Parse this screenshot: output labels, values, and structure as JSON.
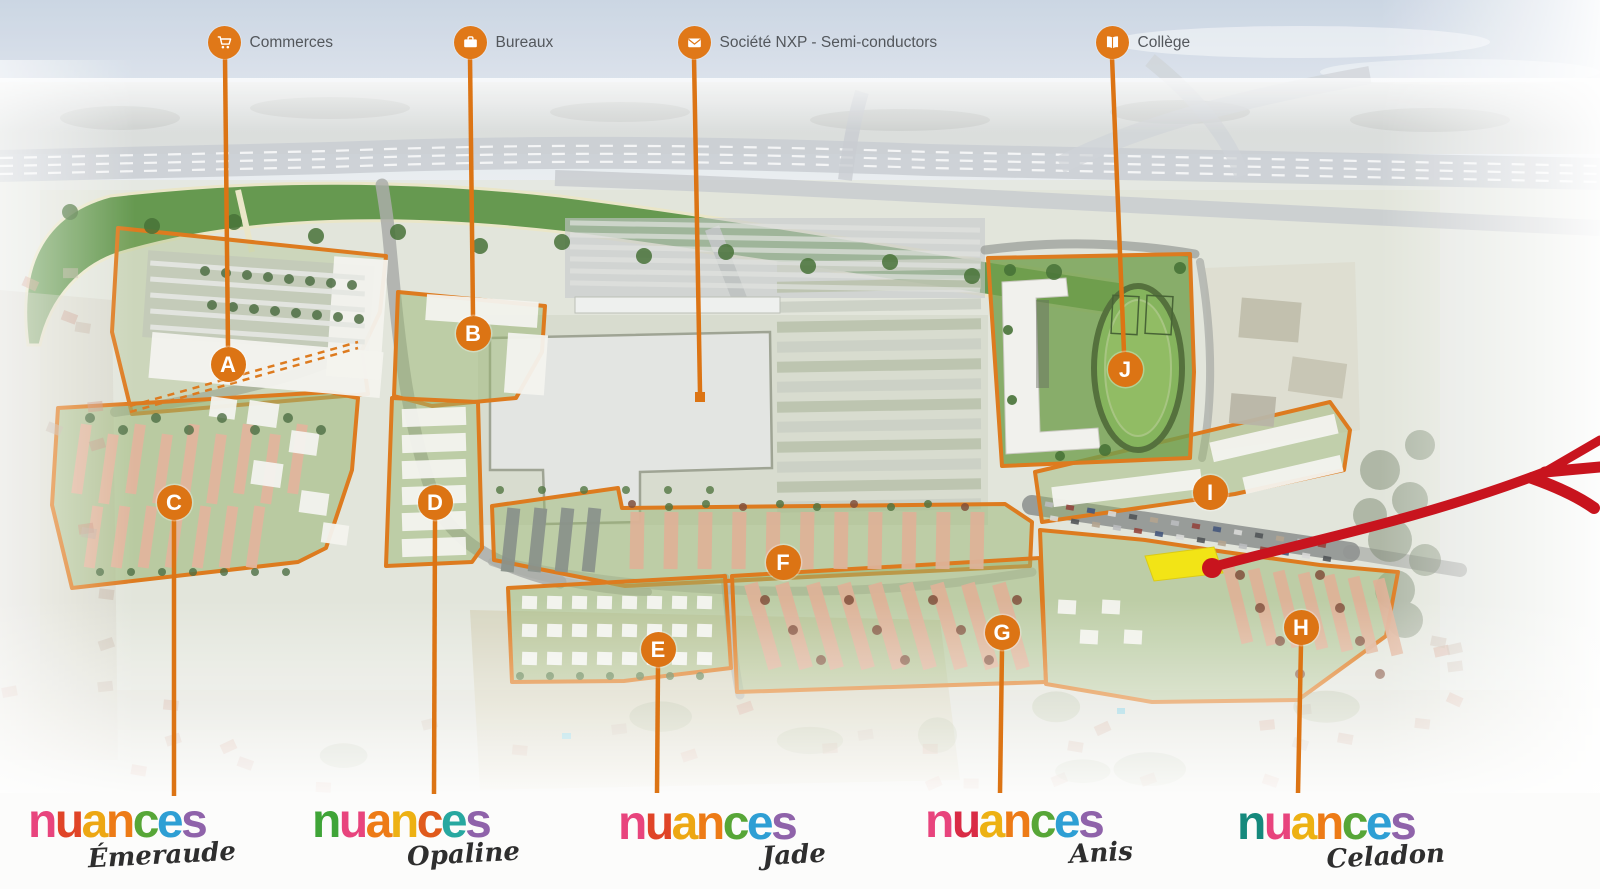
{
  "legend": {
    "items": [
      {
        "icon": "shopping-cart-icon",
        "label": "Commerces"
      },
      {
        "icon": "briefcase-icon",
        "label": "Bureaux"
      },
      {
        "icon": "envelope-icon",
        "label": "Société NXP - Semi-conductors"
      },
      {
        "icon": "open-book-icon",
        "label": "Collège"
      }
    ]
  },
  "zones": {
    "items": [
      {
        "letter": "A"
      },
      {
        "letter": "B"
      },
      {
        "letter": "C"
      },
      {
        "letter": "D"
      },
      {
        "letter": "E"
      },
      {
        "letter": "F"
      },
      {
        "letter": "G"
      },
      {
        "letter": "H"
      },
      {
        "letter": "I"
      },
      {
        "letter": "J"
      }
    ]
  },
  "colors": {
    "accent_orange": "#dc7414",
    "highlight_yellow": "#f2e30a",
    "arrow_red": "#c8141e"
  },
  "logos": {
    "brand": "nuances",
    "items": [
      {
        "name": "Émeraude",
        "letter_colors": [
          "#e8447d",
          "#e04427",
          "#eda713",
          "#ed7b16",
          "#57a637",
          "#2e9fd4",
          "#8f63aa"
        ]
      },
      {
        "name": "Opaline",
        "letter_colors": [
          "#3fa437",
          "#e8447d",
          "#ed7b16",
          "#edb113",
          "#e05a1c",
          "#27a8a0",
          "#8f63aa"
        ]
      },
      {
        "name": "Jade",
        "letter_colors": [
          "#e8447d",
          "#e04427",
          "#eda713",
          "#ed7b16",
          "#57a637",
          "#2e9fd4",
          "#8f63aa"
        ]
      },
      {
        "name": "Anis",
        "letter_colors": [
          "#e8447d",
          "#d92b45",
          "#edb113",
          "#ed7b16",
          "#57a637",
          "#2e9fd4",
          "#8f63aa"
        ]
      },
      {
        "name": "Celadon",
        "letter_colors": [
          "#15897c",
          "#e8447d",
          "#edb113",
          "#ed7b16",
          "#57a637",
          "#2e9fd4",
          "#8f63aa"
        ]
      }
    ]
  }
}
